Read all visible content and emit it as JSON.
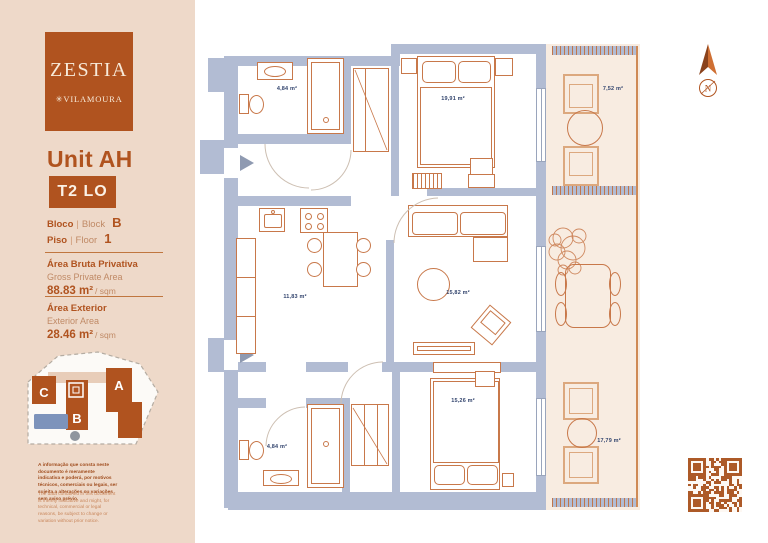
{
  "sidebar": {
    "logo": {
      "brand": "ZESTIA",
      "mark": "✳",
      "location": "VILAMOURA"
    },
    "unit_title": "Unit AH",
    "unit_type": "T2 LO",
    "block": {
      "label_pt": "Bloco",
      "divider": "|",
      "label_en": "Block",
      "value": "B"
    },
    "floor": {
      "label_pt": "Piso",
      "divider": "|",
      "label_en": "Floor",
      "value": "1"
    },
    "private_area": {
      "label_pt": "Área Bruta Privativa",
      "label_en": "Gross Private Area",
      "value": "88.83 m²",
      "suffix": "/ sqm"
    },
    "exterior_area": {
      "label_pt": "Área Exterior",
      "label_en": "Exterior Area",
      "value": "28.46 m²",
      "suffix": "/ sqm"
    },
    "site_map": {
      "block_a": "A",
      "block_b": "B",
      "block_c": "C"
    },
    "disclaimer_pt": "A informação que consta neste documento é meramente indicativa e poderá, por motivos técnicos, comerciais ou legais, ser sujeita a alterações ou variações sem aviso prévio.",
    "disclaimer_en": "The data contained in this document is merely indicative and might, for technical, commercial or legal reasons, be subject to change or variation without prior notice."
  },
  "floor_plan": {
    "compass": "N",
    "rooms": {
      "bathroom_top": "4,84 m²",
      "bedroom_top": "19,91 m²",
      "terrace_top": "7,52 m²",
      "kitchen": "11,83 m²",
      "living_room": "15,82 m²",
      "bathroom_bottom": "4,84 m²",
      "bedroom_bottom": "15,26 m²",
      "terrace_bottom": "17,79 m²"
    }
  },
  "colors": {
    "accent": "#b0531f",
    "wall": "#b2bcd3",
    "furniture_line": "#c8784a",
    "terrace_fill": "#f8ece1",
    "room_label": "#33456e",
    "sidebar_bg": "#eed9c9"
  }
}
